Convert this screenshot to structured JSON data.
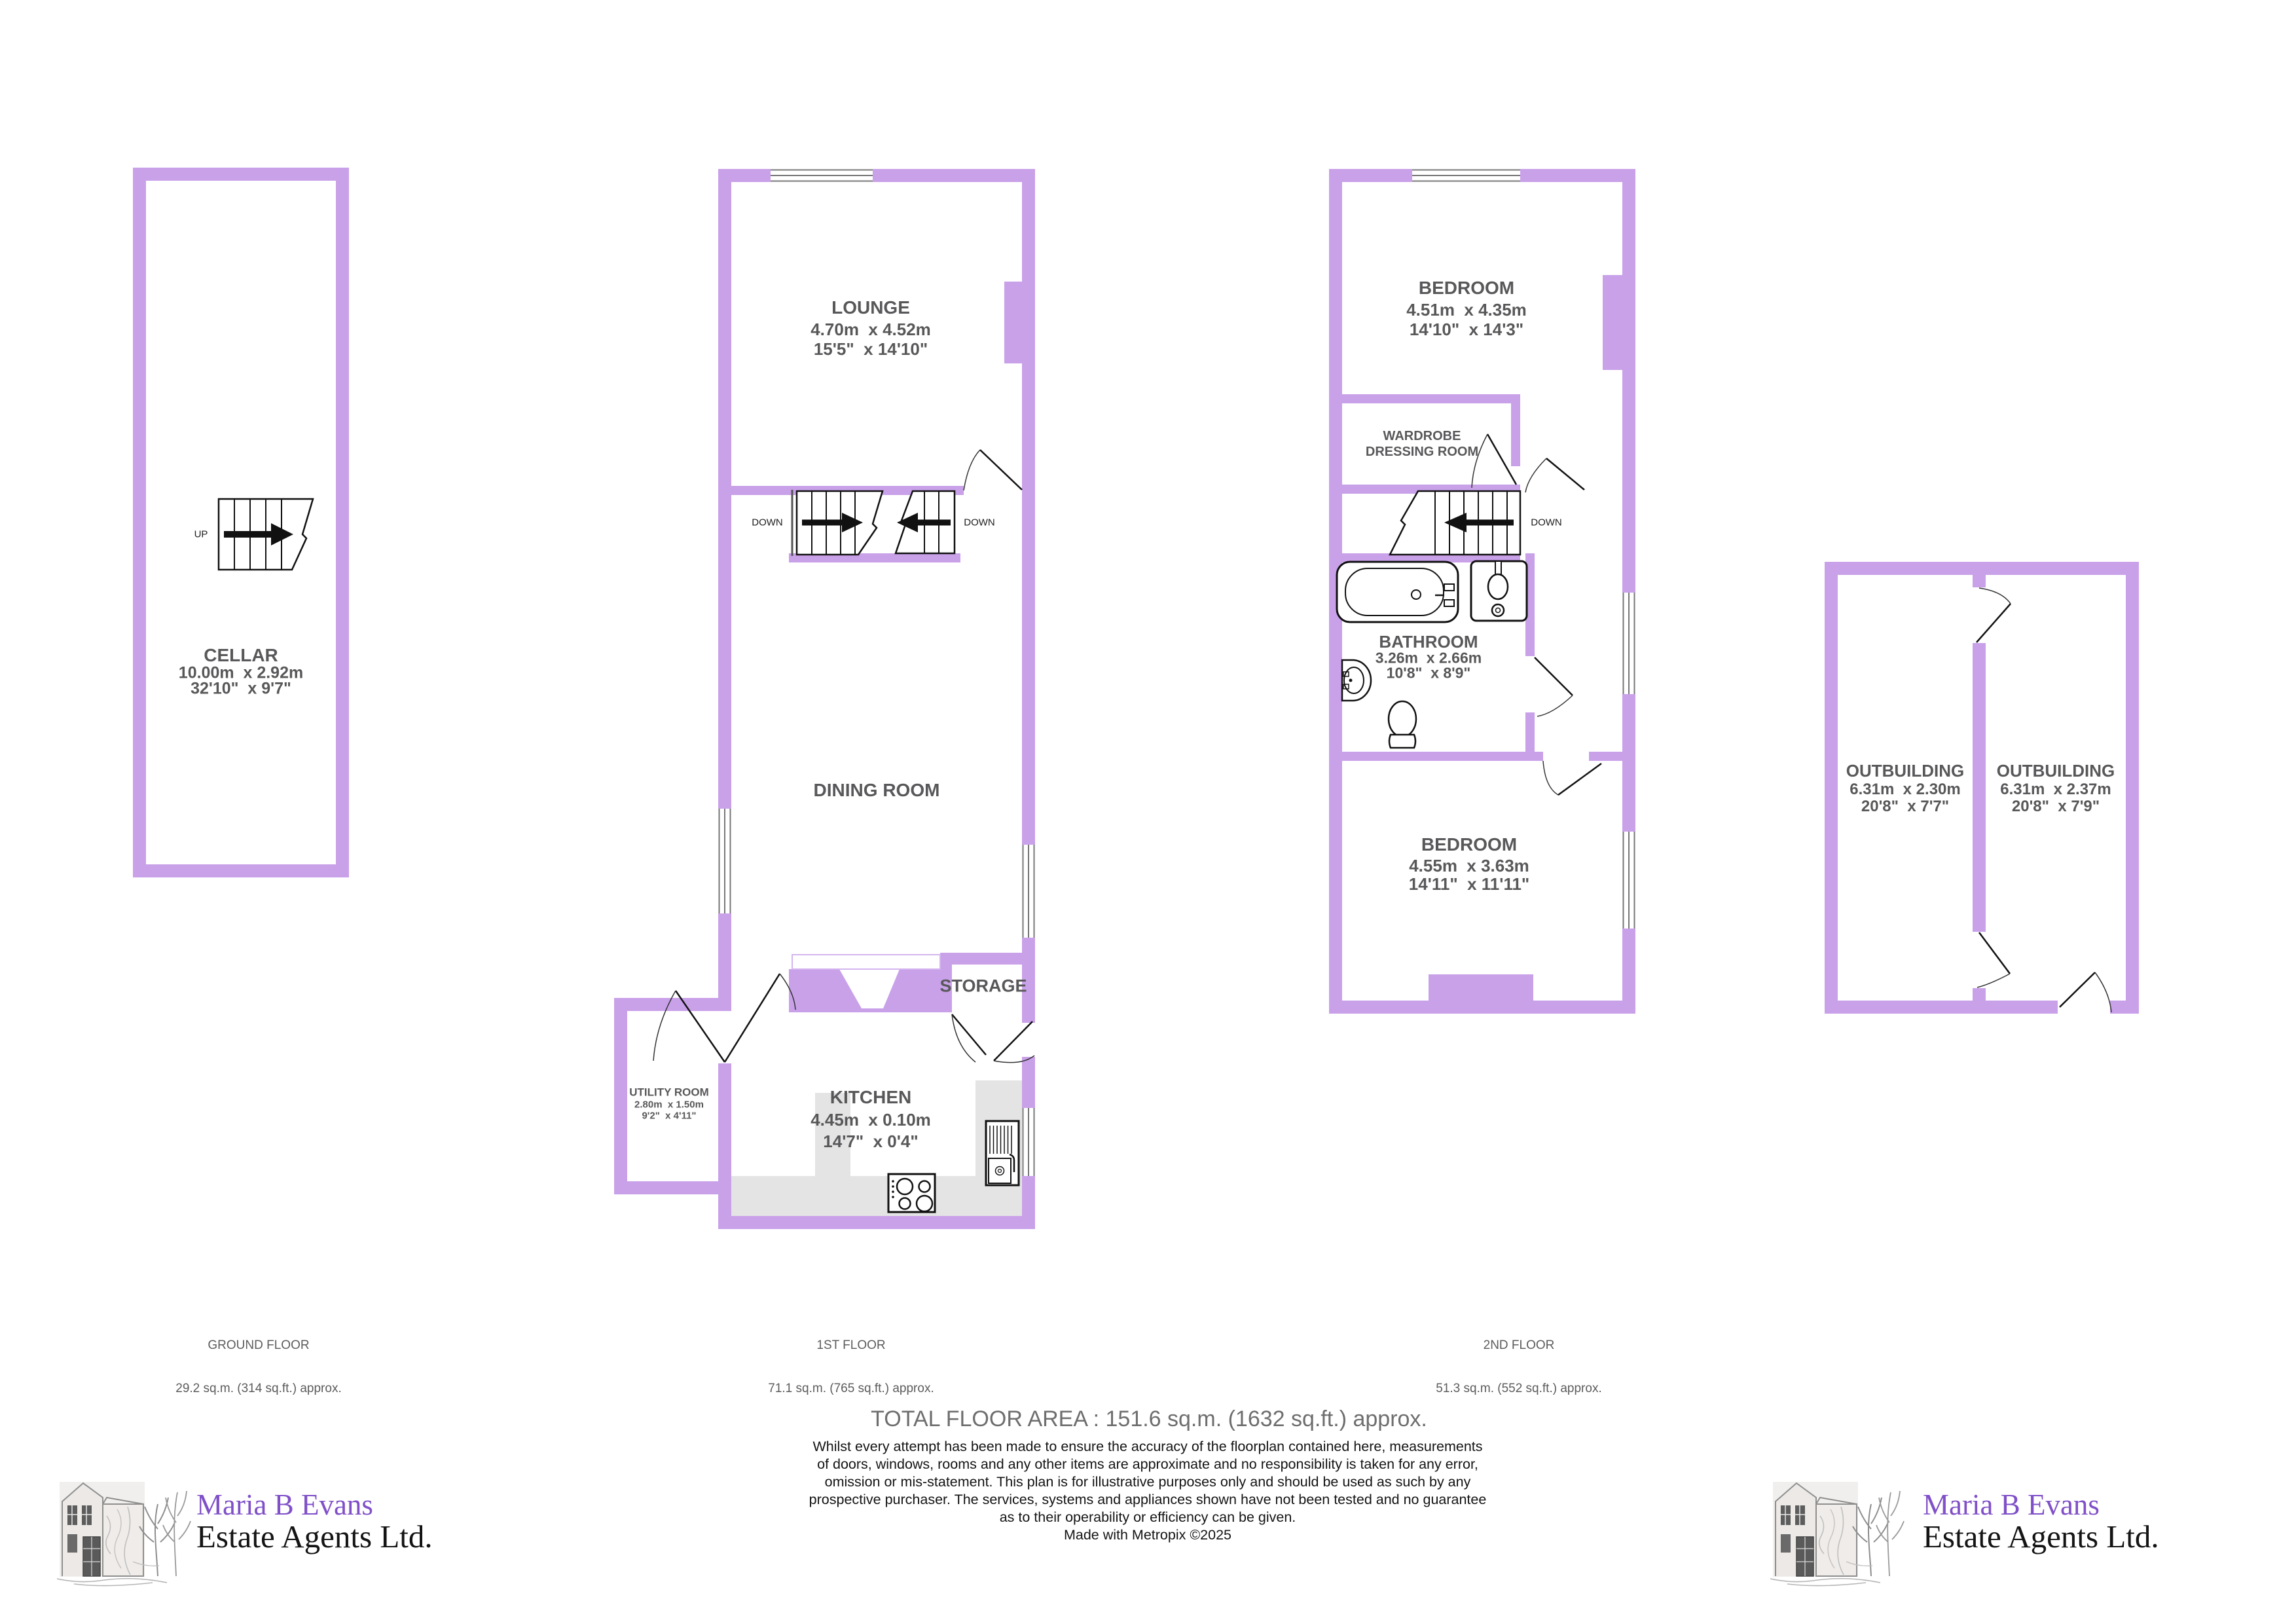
{
  "colors": {
    "wall": "#c9a1e9",
    "wall_light_outline": "#d4b4ef",
    "room_text": "#58585a",
    "counter_gray": "#e4e4e4",
    "logo_purple": "#8050c8",
    "window_line": "#777777"
  },
  "plans": {
    "ground": {
      "floor_label": "GROUND FLOOR",
      "area_label": "29.2 sq.m. (314 sq.ft.) approx.",
      "stair_label": "UP",
      "rooms": {
        "cellar": {
          "name": "CELLAR",
          "metric": "10.00m  x 2.92m",
          "imperial": "32'10\"  x 9'7\""
        }
      }
    },
    "first": {
      "floor_label": "1ST FLOOR",
      "area_label": "71.1 sq.m. (765 sq.ft.) approx.",
      "stair_label_left": "DOWN",
      "stair_label_right": "DOWN",
      "rooms": {
        "lounge": {
          "name": "LOUNGE",
          "metric": "4.70m  x 4.52m",
          "imperial": "15'5\"  x 14'10\""
        },
        "dining": {
          "name": "DINING ROOM"
        },
        "storage": {
          "name": "STORAGE"
        },
        "kitchen": {
          "name": "KITCHEN",
          "metric": "4.45m  x 0.10m",
          "imperial": "14'7\"  x 0'4\""
        },
        "utility": {
          "name": "UTILITY ROOM",
          "metric": "2.80m  x 1.50m",
          "imperial": "9'2\"  x 4'11\""
        }
      }
    },
    "second": {
      "floor_label": "2ND FLOOR",
      "area_label": "51.3 sq.m. (552 sq.ft.) approx.",
      "stair_label": "DOWN",
      "rooms": {
        "bedroom1": {
          "name": "BEDROOM",
          "metric": "4.51m  x 4.35m",
          "imperial": "14'10\"  x 14'3\""
        },
        "wardrobe": {
          "name_line1": "WARDROBE",
          "name_line2": "DRESSING ROOM"
        },
        "bathroom": {
          "name": "BATHROOM",
          "metric": "3.26m  x 2.66m",
          "imperial": "10'8\"  x 8'9\""
        },
        "bedroom2": {
          "name": "BEDROOM",
          "metric": "4.55m  x 3.63m",
          "imperial": "14'11\"  x 11'11\""
        }
      }
    },
    "outbuildings": {
      "left": {
        "name": "OUTBUILDING",
        "metric": "6.31m  x 2.30m",
        "imperial": "20'8\"  x 7'7\""
      },
      "right": {
        "name": "OUTBUILDING",
        "metric": "6.31m  x 2.37m",
        "imperial": "20'8\"  x 7'9\""
      }
    }
  },
  "footer": {
    "total": "TOTAL FLOOR AREA : 151.6 sq.m. (1632 sq.ft.) approx.",
    "disclaimer_lines": [
      "Whilst every attempt has been made to ensure the accuracy of the floorplan contained here, measurements",
      "of doors, windows, rooms and any other items are approximate and no responsibility is taken for any error,",
      "omission or mis-statement. This plan is for illustrative purposes only and should be used as such by any",
      "prospective purchaser. The services, systems and appliances shown have not been tested and no guarantee",
      "as to their operability or efficiency can be given.",
      "Made with Metropix ©2025"
    ]
  },
  "logo": {
    "line1": "Maria B Evans",
    "line2": "Estate Agents Ltd."
  }
}
